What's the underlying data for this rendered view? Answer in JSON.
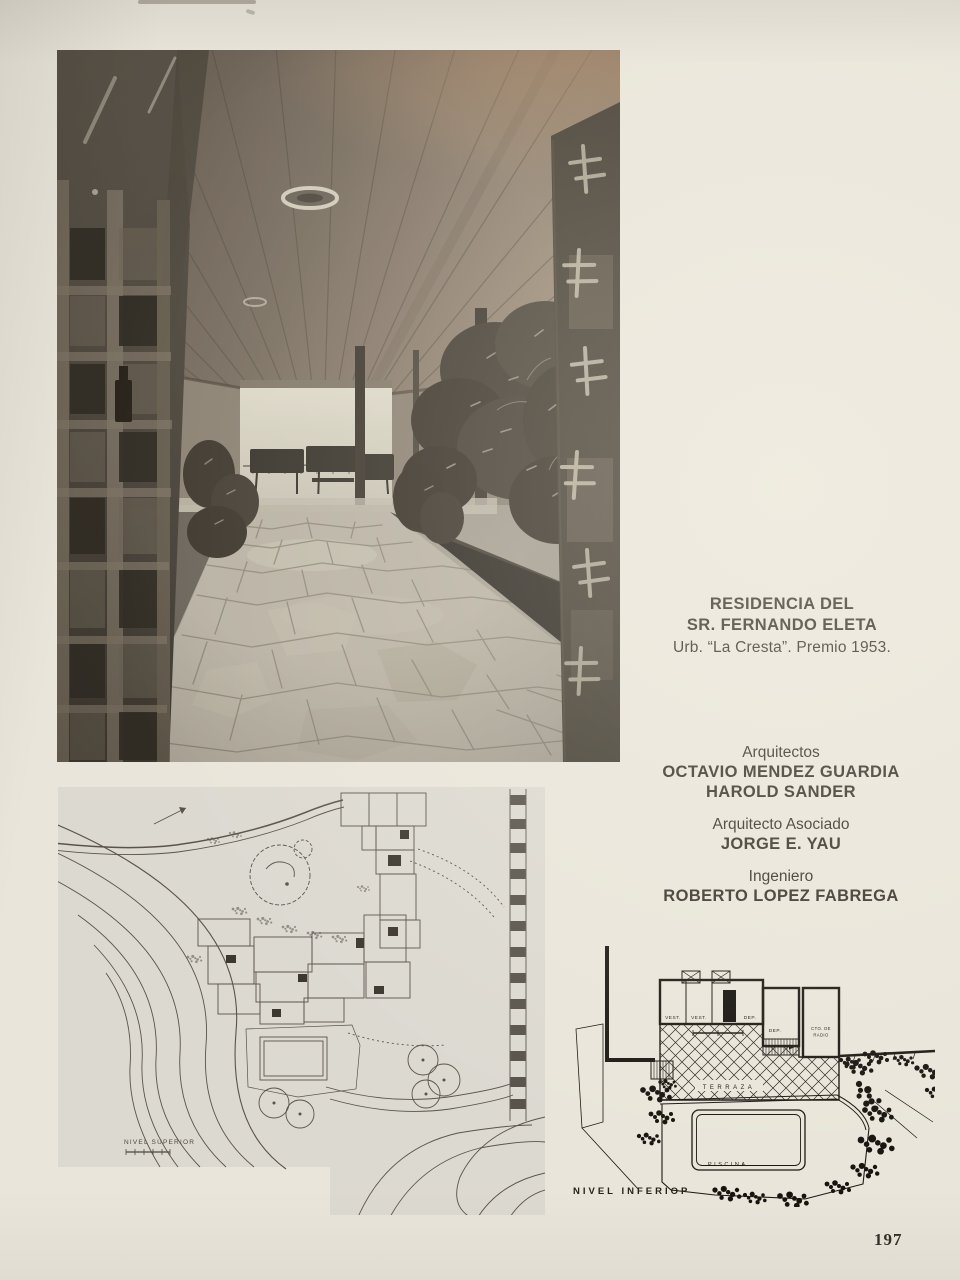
{
  "page": {
    "number": "197"
  },
  "caption": {
    "title_line1": "RESIDENCIA DEL",
    "title_line2": "SR. FERNANDO ELETA",
    "subtitle": "Urb. “La Cresta”. Premio 1953."
  },
  "credits": {
    "group1_role": "Arquitectos",
    "group1_name1": "OCTAVIO MENDEZ GUARDIA",
    "group1_name2": "HAROLD SANDER",
    "group2_role": "Arquitecto Asociado",
    "group2_name": "JORGE E. YAU",
    "group3_role": "Ingeniero",
    "group3_name": "ROBERTO LOPEZ FABREGA"
  },
  "upper_plan": {
    "label": "NIVEL SUPERIOR"
  },
  "lower_plan": {
    "label": "NIVEL INFERIOP",
    "room_vest_1": "VEST.",
    "room_vest_2": "VEST.",
    "room_dep_1": "DEP.",
    "room_dep_2": "DEP.",
    "room_radio_line1": "CTO. DE",
    "room_radio_line2": "RADIO",
    "area_terraza": "TERRAZA",
    "area_piscina": "PISCINA"
  },
  "colors": {
    "paper": "#e9e5da",
    "text_ink": "#39352e",
    "plan_paper": "#dcd9d1",
    "drawing_ink": "#1c1813"
  }
}
